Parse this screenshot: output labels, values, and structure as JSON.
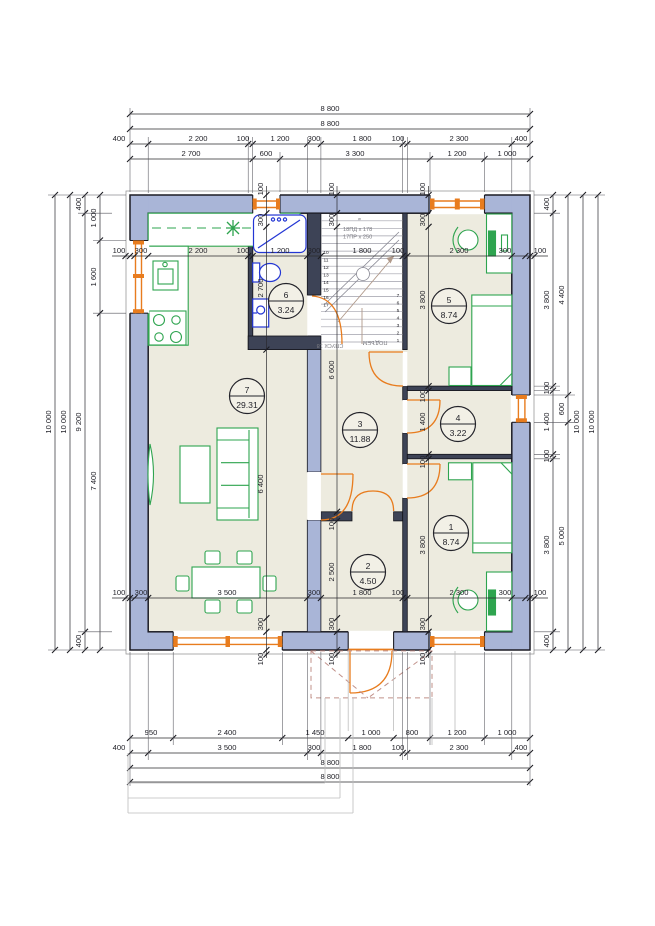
{
  "colors": {
    "wall_fill": "#a9b5d7",
    "interior_wall_fill": "#3d4356",
    "floor_fill": "#edebdf",
    "furniture_green": "#2ea44f",
    "plumbing_blue": "#2336d4",
    "joinery_orange": "#e87c1e",
    "porch_dash": "#c09089"
  },
  "rooms": [
    {
      "num": "1",
      "area": "8.74"
    },
    {
      "num": "2",
      "area": "4.50"
    },
    {
      "num": "3",
      "area": "11.88"
    },
    {
      "num": "4",
      "area": "3.22"
    },
    {
      "num": "5",
      "area": "8.74"
    },
    {
      "num": "6",
      "area": "3.24"
    },
    {
      "num": "7",
      "area": "29.31"
    }
  ],
  "stairs": {
    "spec1": "18ПД x 178",
    "spec2": "17ПР x 250",
    "descent": "СПУСК 18",
    "ascent": "ПОДЪЕМ",
    "mid": "9",
    "steps_left": [
      "10",
      "11",
      "12",
      "13",
      "14",
      "15",
      "16",
      "17"
    ],
    "steps_right": [
      "7",
      "6",
      "5",
      "4",
      "3",
      "2",
      "1"
    ]
  },
  "dims": {
    "t1": "8 800",
    "t2": "8 800",
    "t3": [
      "400",
      "2 200",
      "100",
      "1 200",
      "300",
      "1 800",
      "100",
      "2 300",
      "400"
    ],
    "t4": [
      "2 700",
      "600",
      "3 300",
      "1 200",
      "1 000"
    ],
    "it": [
      "100",
      "300",
      "2 200",
      "100",
      "1 200",
      "300",
      "1 800",
      "100",
      "2 300",
      "300",
      "100"
    ],
    "ib": [
      "100",
      "300",
      "3 500",
      "300",
      "1 800",
      "100",
      "2 300",
      "300",
      "100"
    ],
    "b1": [
      "950",
      "2 400",
      "1 450",
      "1 000",
      "800",
      "1 200",
      "1 000"
    ],
    "b2": [
      "400",
      "3 500",
      "300",
      "1 800",
      "100",
      "2 300",
      "400"
    ],
    "b3": "8 800",
    "b4": "8 800",
    "l1": "10 000",
    "l2": "10 000",
    "l3": [
      "400",
      "9 200",
      "400"
    ],
    "l4": [
      "1 000",
      "1 600",
      "7 400"
    ],
    "r1": [
      "400",
      "3 800",
      "100",
      "1 400",
      "100",
      "3 800",
      "400"
    ],
    "r2": [
      "4 400",
      "600",
      "5 000"
    ],
    "r3": "10 000",
    "r4": "10 000",
    "vb": [
      "300",
      "2 700"
    ],
    "vh": [
      "300",
      "6 600",
      "100",
      "2 500",
      "300"
    ],
    "vr": [
      "300",
      "3 800",
      "100",
      "1 400",
      "100",
      "3 800",
      "300"
    ],
    "vl": [
      "6 400",
      "300",
      "100"
    ],
    "w100": "100"
  }
}
